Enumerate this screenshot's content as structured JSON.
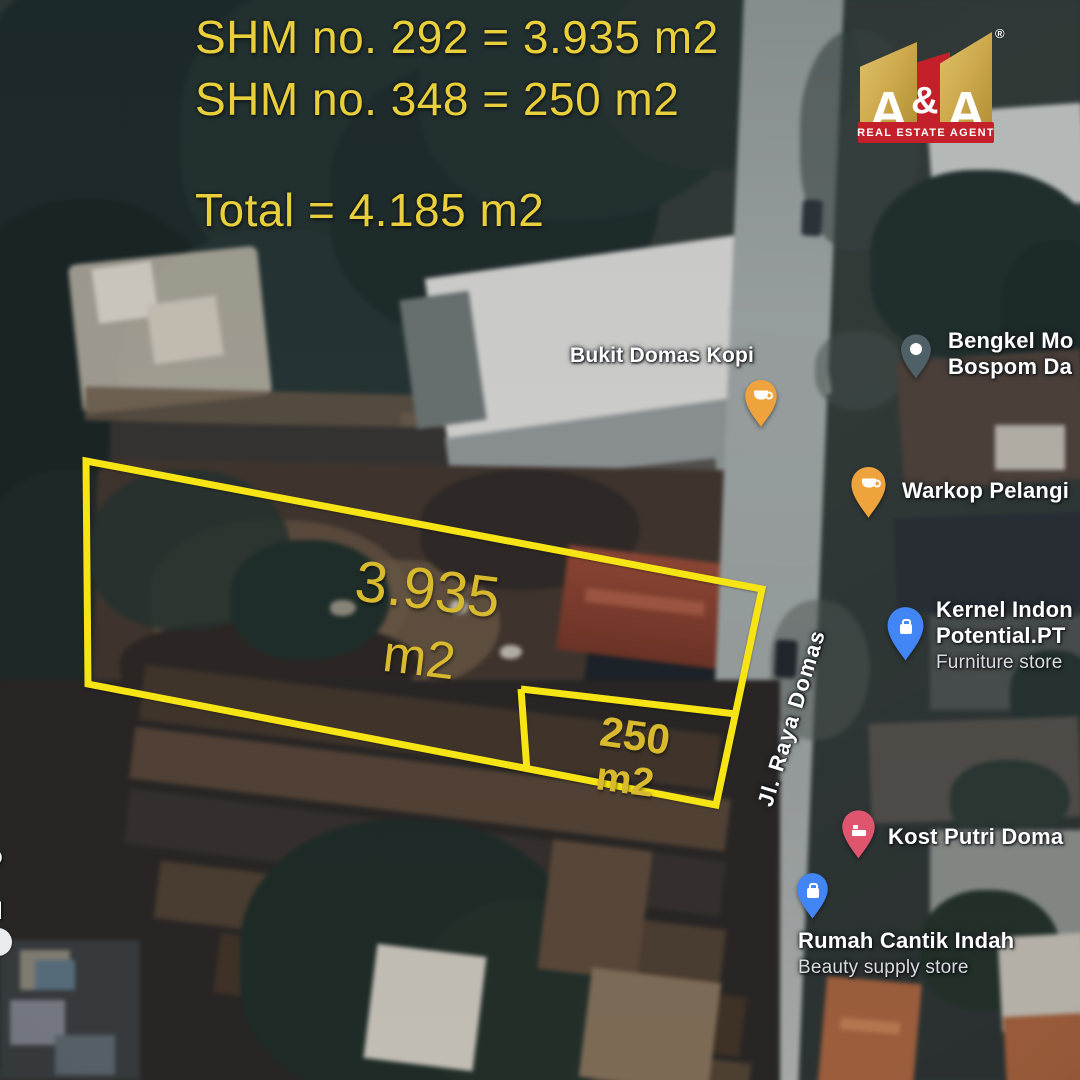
{
  "title_block": {
    "line1": "SHM no. 292 = 3.935 m2",
    "line2": "SHM no. 348 = 250 m2",
    "line3": "Total = 4.185 m2",
    "text_color": "#e8cf3b"
  },
  "logo": {
    "letter_left": "A",
    "ampersand": "&",
    "letter_right": "A",
    "registered_mark": "®",
    "banner_text": "REAL ESTATE AGENT",
    "gold_color": "#cda94c",
    "red_color": "#c4202b"
  },
  "plots": {
    "outline_color": "#f7e414",
    "label_color": "#d9ba2e",
    "big_plot": {
      "certificate": "SHM no. 292",
      "area_value": "3.935",
      "area_unit": "m2"
    },
    "small_plot": {
      "certificate": "SHM no. 348",
      "area_value": "250",
      "area_unit": "m2"
    }
  },
  "map_labels": {
    "street": "Jl. Raya Domas",
    "pois": [
      {
        "name": "Bukit Domas Kopi",
        "icon": "coffee-pin",
        "pin_color": "#efa33d"
      },
      {
        "name": "Bengkel Mo",
        "name_line2": "Bospom Da",
        "icon": "place-pin",
        "pin_color": "#4f6167"
      },
      {
        "name": "Warkop Pelangi",
        "icon": "coffee-pin",
        "pin_color": "#efa33d"
      },
      {
        "name": "Kernel Indon",
        "name_line2": "Potential.PT",
        "subtitle": "Furniture store",
        "icon": "shopping-pin",
        "pin_color": "#4285f4"
      },
      {
        "name": "Kost Putri Doma",
        "icon": "lodging-pin",
        "pin_color": "#e0556e"
      },
      {
        "name": "Rumah Cantik Indah",
        "subtitle": "Beauty supply store",
        "icon": "shopping-pin",
        "pin_color": "#4285f4"
      }
    ],
    "left_edge_fragments": [
      "o",
      "i",
      "d"
    ]
  }
}
